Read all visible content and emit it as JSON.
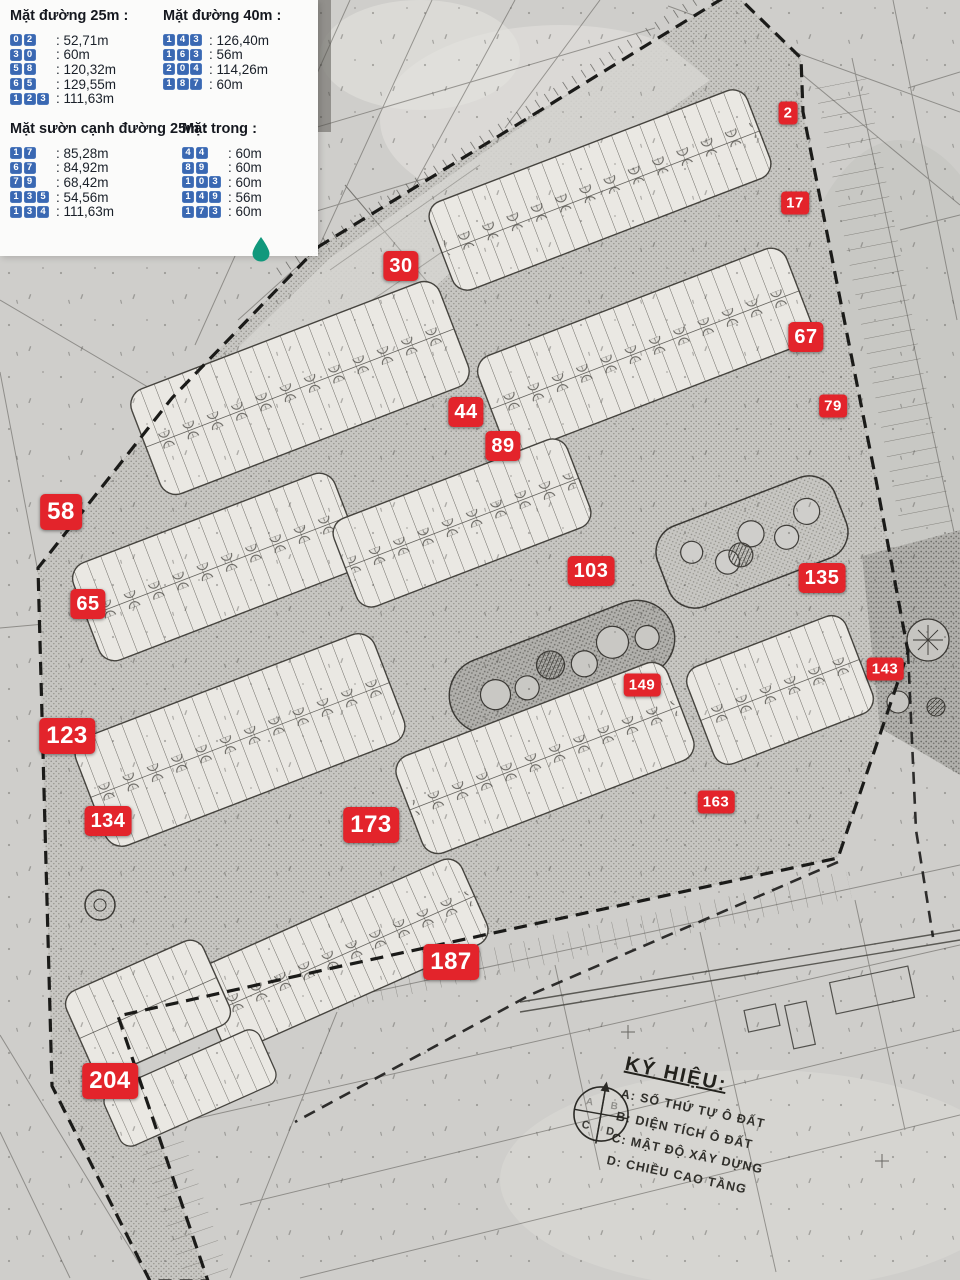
{
  "legend": {
    "groups": [
      {
        "title": "Mặt đường 25m :",
        "entries": [
          {
            "code": "02",
            "value": "52,71m"
          },
          {
            "code": "30",
            "value": "60m"
          },
          {
            "code": "58",
            "value": "120,32m"
          },
          {
            "code": "65",
            "value": "129,55m"
          },
          {
            "code": "123",
            "value": "111,63m"
          }
        ]
      },
      {
        "title": "Mặt đường 40m :",
        "entries": [
          {
            "code": "143",
            "value": "126,40m"
          },
          {
            "code": "163",
            "value": "56m"
          },
          {
            "code": "204",
            "value": "114,26m"
          },
          {
            "code": "187",
            "value": "60m"
          }
        ]
      },
      {
        "title": "Mặt sườn cạnh đường 25m :",
        "entries": [
          {
            "code": "17",
            "value": "85,28m"
          },
          {
            "code": "67",
            "value": "84,92m"
          },
          {
            "code": "79",
            "value": "68,42m"
          },
          {
            "code": "135",
            "value": "54,56m"
          },
          {
            "code": "134",
            "value": "111,63m"
          }
        ]
      },
      {
        "title": "Mặt trong :",
        "entries": [
          {
            "code": "44",
            "value": "60m"
          },
          {
            "code": "89",
            "value": "60m"
          },
          {
            "code": "103",
            "value": "60m"
          },
          {
            "code": "149",
            "value": "56m"
          },
          {
            "code": "173",
            "value": "60m"
          }
        ]
      }
    ]
  },
  "markers": [
    {
      "label": "2",
      "x": 788,
      "y": 113,
      "size": "sm"
    },
    {
      "label": "17",
      "x": 795,
      "y": 203,
      "size": "sm"
    },
    {
      "label": "30",
      "x": 401,
      "y": 266,
      "size": "lg"
    },
    {
      "label": "67",
      "x": 806,
      "y": 337,
      "size": "lg"
    },
    {
      "label": "79",
      "x": 833,
      "y": 406,
      "size": "sm"
    },
    {
      "label": "44",
      "x": 466,
      "y": 412,
      "size": "lg"
    },
    {
      "label": "89",
      "x": 503,
      "y": 446,
      "size": "lg"
    },
    {
      "label": "58",
      "x": 61,
      "y": 512,
      "size": "xl"
    },
    {
      "label": "103",
      "x": 591,
      "y": 571,
      "size": "lg"
    },
    {
      "label": "135",
      "x": 822,
      "y": 578,
      "size": "lg"
    },
    {
      "label": "65",
      "x": 88,
      "y": 604,
      "size": "lg"
    },
    {
      "label": "143",
      "x": 885,
      "y": 669,
      "size": "sm"
    },
    {
      "label": "149",
      "x": 642,
      "y": 685,
      "size": "sm"
    },
    {
      "label": "123",
      "x": 67,
      "y": 736,
      "size": "xl"
    },
    {
      "label": "163",
      "x": 716,
      "y": 802,
      "size": "sm"
    },
    {
      "label": "134",
      "x": 108,
      "y": 821,
      "size": "lg"
    },
    {
      "label": "173",
      "x": 371,
      "y": 825,
      "size": "xl"
    },
    {
      "label": "187",
      "x": 451,
      "y": 962,
      "size": "xl"
    },
    {
      "label": "204",
      "x": 110,
      "y": 1081,
      "size": "xl"
    }
  ],
  "map_key": {
    "title": "KÝ HIỆU:",
    "items": [
      "A: SỐ THỨ TỰ Ô ĐẤT",
      "B: DIỆN TÍCH Ô ĐẤT",
      "C: MẬT ĐỘ XÂY DỰNG",
      "D: CHIỀU CAO TẦNG"
    ],
    "symbol_quadrants": [
      "A",
      "B",
      "C",
      "D"
    ]
  },
  "colors": {
    "marker_red": "#e3242b",
    "tile_blue": "#3a68b2",
    "pin_teal": "#11987c"
  }
}
